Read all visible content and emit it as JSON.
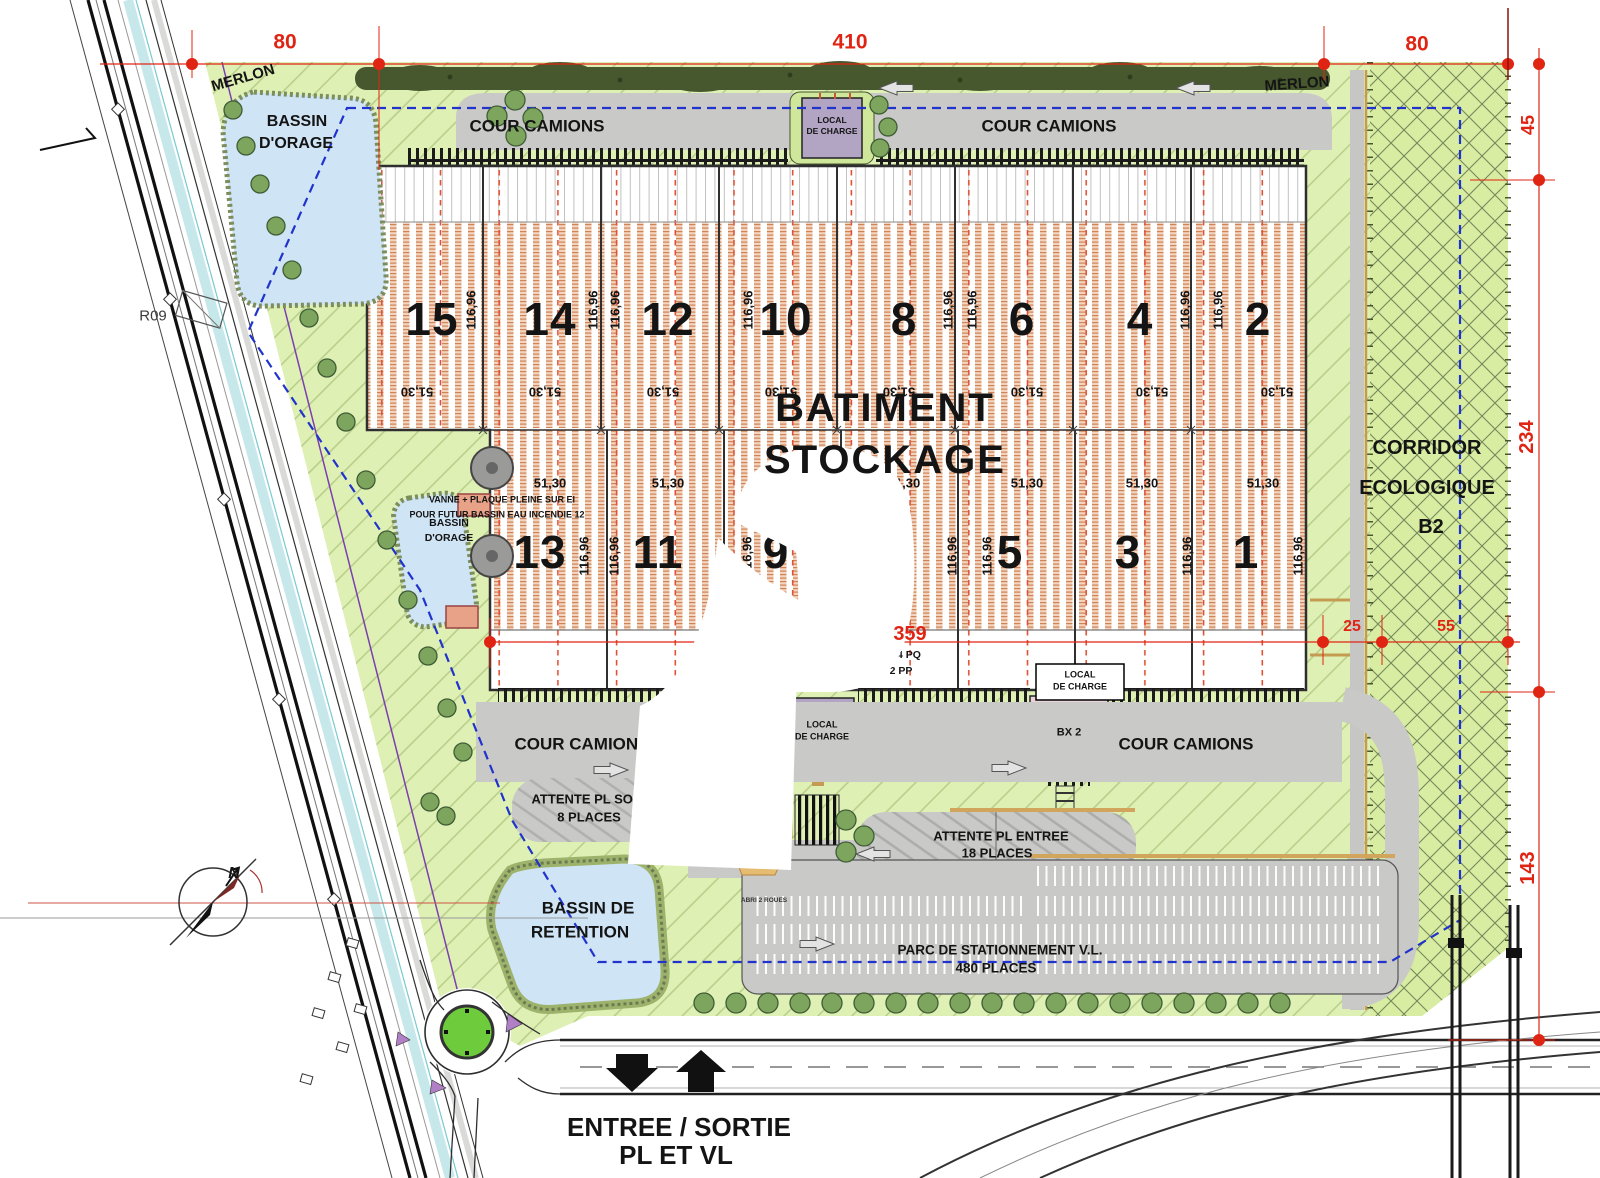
{
  "dimensions": {
    "top_left": "80",
    "top_center": "410",
    "top_right": "80",
    "right_upper": "45",
    "right_middle": "234",
    "right_lower": "143",
    "bottom_building": "359",
    "offset": "25",
    "corridor_width": "55"
  },
  "building": {
    "title_l1": "BATIMENT",
    "title_l2": "STOCKAGE",
    "cells_top": [
      "15",
      "14",
      "12",
      "10",
      "8",
      "6",
      "4",
      "2"
    ],
    "cells_bottom": [
      "13",
      "11",
      "9",
      "5",
      "3",
      "1"
    ],
    "depth": "116,96",
    "bay": "51,30",
    "pq": "34 PQ",
    "pp": "2 PP"
  },
  "labels": {
    "merlon": "MERLON",
    "cour_camions": "COUR CAMIONS",
    "bassin_orage_l1": "BASSIN",
    "bassin_orage_l2": "D'ORAGE",
    "r09": "R09",
    "vanne_l1": "VANNE + PLAQUE PLEINE SUR EI",
    "vanne_l2": "POUR FUTUR BASSIN EAU INCENDIE 12",
    "local_l1": "LOCAL",
    "local_l2": "DE CHARGE",
    "bx1": "BX 1",
    "bx2": "BX 2",
    "attente_sortie_l1": "ATTENTE PL SORTIE",
    "attente_sortie_l2": "8 PLACES",
    "attente_entree_l1": "ATTENTE PL ENTREE",
    "attente_entree_l2": "18 PLACES",
    "abri": "ABRI 2 ROUES",
    "parking_l1": "PARC DE STATIONNEMENT V.L.",
    "parking_l2": "480 PLACES",
    "bassin_retention_l1": "BASSIN DE",
    "bassin_retention_l2": "RETENTION",
    "corridor_l1": "CORRIDOR",
    "corridor_l2": "ECOLOGIQUE",
    "corridor_l3": "B2",
    "entree_l1": "ENTREE / SORTIE",
    "entree_l2": "PL ET VL",
    "north": "N"
  },
  "colors": {
    "dimension_red": "#e02413",
    "boundary_blue": "#2033cc",
    "building_hatch": "#cf8457",
    "landscape_green": "#dff0b5",
    "corridor_green": "#d9eda2",
    "pond_blue": "#cfe4f5",
    "road_gray": "#c9c9c7",
    "hedge_green": "#47582e",
    "local_purple": "#b2a5c3",
    "dock_pink": "#ecd2da",
    "guard_tan": "#e6bb72",
    "roundabout_green": "#6ecb3c"
  }
}
